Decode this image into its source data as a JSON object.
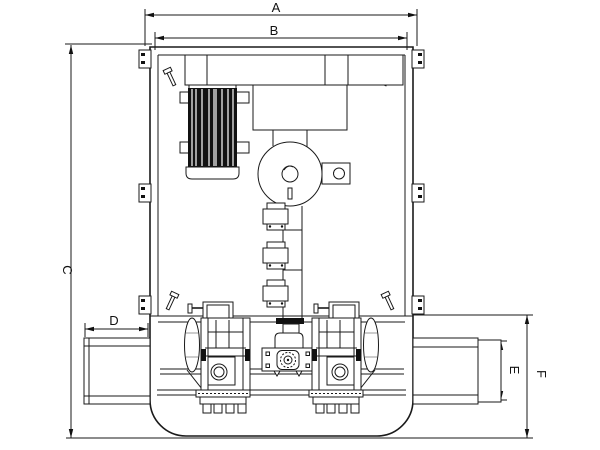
{
  "drawing": {
    "dimension_labels": {
      "a": "A",
      "b": "B",
      "c": "C",
      "d": "D",
      "e": "E",
      "f": "F"
    },
    "colors": {
      "background": "#ffffff",
      "line": "#1a1a1a"
    }
  }
}
